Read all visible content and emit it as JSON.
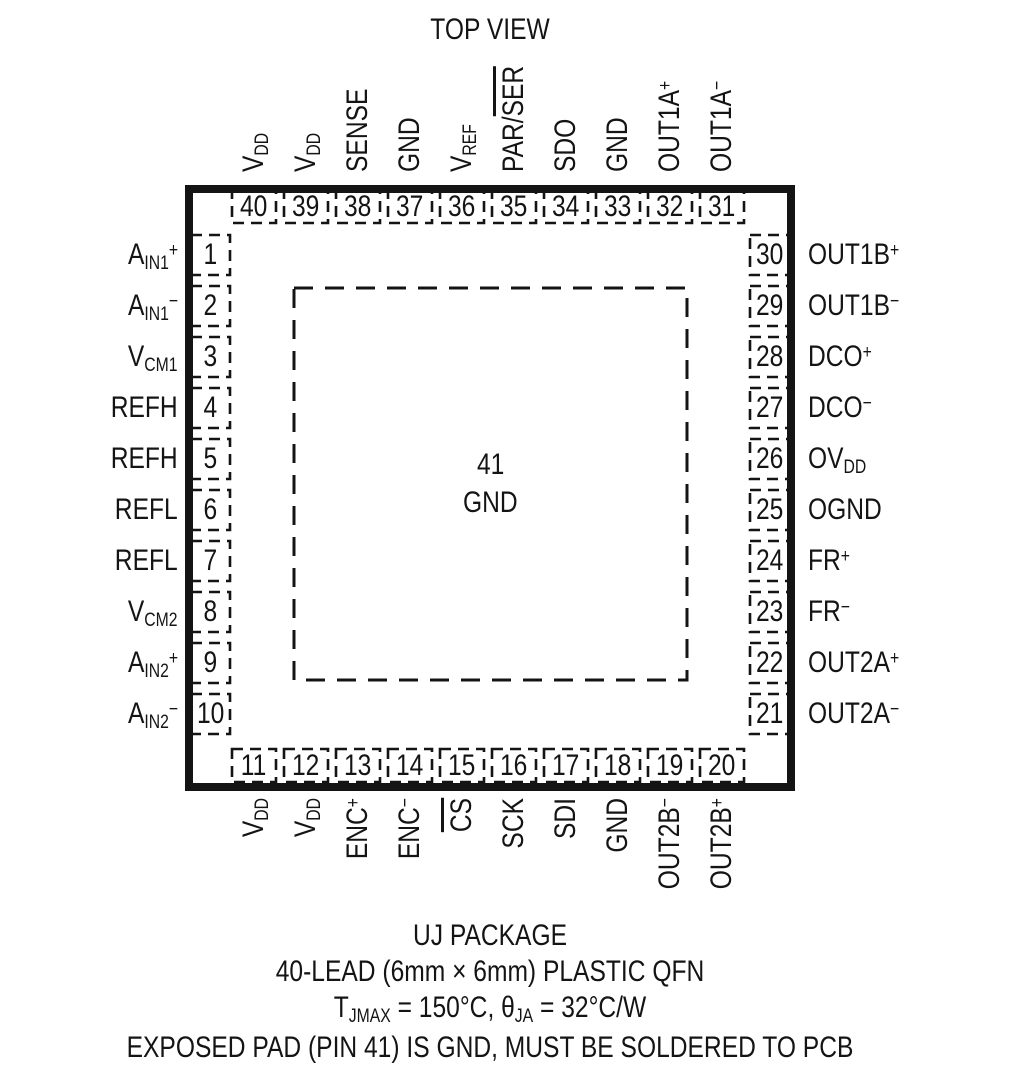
{
  "title": "TOP VIEW",
  "colors": {
    "ink": "#141414",
    "background": "#ffffff"
  },
  "package": {
    "center_pad": {
      "number": "41",
      "label": "GND"
    }
  },
  "pins": {
    "top": [
      {
        "num": "40",
        "label": [
          [
            "V"
          ],
          [
            "DD",
            "sub"
          ]
        ]
      },
      {
        "num": "39",
        "label": [
          [
            "V"
          ],
          [
            "DD",
            "sub"
          ]
        ]
      },
      {
        "num": "38",
        "label": [
          [
            "SENSE"
          ]
        ]
      },
      {
        "num": "37",
        "label": [
          [
            "GND"
          ]
        ]
      },
      {
        "num": "36",
        "label": [
          [
            "V"
          ],
          [
            "REF",
            "sub"
          ]
        ]
      },
      {
        "num": "35",
        "label": [
          [
            "PAR/"
          ],
          [
            "SER",
            "over"
          ]
        ]
      },
      {
        "num": "34",
        "label": [
          [
            "SDO"
          ]
        ]
      },
      {
        "num": "33",
        "label": [
          [
            "GND"
          ]
        ]
      },
      {
        "num": "32",
        "label": [
          [
            "OUT1A"
          ],
          [
            "+",
            "sup"
          ]
        ]
      },
      {
        "num": "31",
        "label": [
          [
            "OUT1A"
          ],
          [
            "−",
            "sup"
          ]
        ]
      }
    ],
    "left": [
      {
        "num": "1",
        "label": [
          [
            "A"
          ],
          [
            "IN1",
            "sub"
          ],
          [
            "+",
            "sup"
          ]
        ]
      },
      {
        "num": "2",
        "label": [
          [
            "A"
          ],
          [
            "IN1",
            "sub"
          ],
          [
            "−",
            "sup"
          ]
        ]
      },
      {
        "num": "3",
        "label": [
          [
            "V"
          ],
          [
            "CM1",
            "sub"
          ]
        ]
      },
      {
        "num": "4",
        "label": [
          [
            "REFH"
          ]
        ]
      },
      {
        "num": "5",
        "label": [
          [
            "REFH"
          ]
        ]
      },
      {
        "num": "6",
        "label": [
          [
            "REFL"
          ]
        ]
      },
      {
        "num": "7",
        "label": [
          [
            "REFL"
          ]
        ]
      },
      {
        "num": "8",
        "label": [
          [
            "V"
          ],
          [
            "CM2",
            "sub"
          ]
        ]
      },
      {
        "num": "9",
        "label": [
          [
            "A"
          ],
          [
            "IN2",
            "sub"
          ],
          [
            "+",
            "sup"
          ]
        ]
      },
      {
        "num": "10",
        "label": [
          [
            "A"
          ],
          [
            "IN2",
            "sub"
          ],
          [
            "−",
            "sup"
          ]
        ]
      }
    ],
    "right": [
      {
        "num": "30",
        "label": [
          [
            "OUT1B"
          ],
          [
            "+",
            "sup"
          ]
        ]
      },
      {
        "num": "29",
        "label": [
          [
            "OUT1B"
          ],
          [
            "−",
            "sup"
          ]
        ]
      },
      {
        "num": "28",
        "label": [
          [
            "DCO"
          ],
          [
            "+",
            "sup"
          ]
        ]
      },
      {
        "num": "27",
        "label": [
          [
            "DCO"
          ],
          [
            "−",
            "sup"
          ]
        ]
      },
      {
        "num": "26",
        "label": [
          [
            "OV"
          ],
          [
            "DD",
            "sub"
          ]
        ]
      },
      {
        "num": "25",
        "label": [
          [
            "OGND"
          ]
        ]
      },
      {
        "num": "24",
        "label": [
          [
            "FR"
          ],
          [
            "+",
            "sup"
          ]
        ]
      },
      {
        "num": "23",
        "label": [
          [
            "FR"
          ],
          [
            "−",
            "sup"
          ]
        ]
      },
      {
        "num": "22",
        "label": [
          [
            "OUT2A"
          ],
          [
            "+",
            "sup"
          ]
        ]
      },
      {
        "num": "21",
        "label": [
          [
            "OUT2A"
          ],
          [
            "−",
            "sup"
          ]
        ]
      }
    ],
    "bottom": [
      {
        "num": "11",
        "label": [
          [
            "V"
          ],
          [
            "DD",
            "sub"
          ]
        ]
      },
      {
        "num": "12",
        "label": [
          [
            "V"
          ],
          [
            "DD",
            "sub"
          ]
        ]
      },
      {
        "num": "13",
        "label": [
          [
            "ENC"
          ],
          [
            "+",
            "sup"
          ]
        ]
      },
      {
        "num": "14",
        "label": [
          [
            "ENC"
          ],
          [
            "−",
            "sup"
          ]
        ]
      },
      {
        "num": "15",
        "label": [
          [
            "CS",
            "over"
          ]
        ]
      },
      {
        "num": "16",
        "label": [
          [
            "SCK"
          ]
        ]
      },
      {
        "num": "17",
        "label": [
          [
            "SDI"
          ]
        ]
      },
      {
        "num": "18",
        "label": [
          [
            "GND"
          ]
        ]
      },
      {
        "num": "19",
        "label": [
          [
            "OUT2B"
          ],
          [
            "−",
            "sup"
          ]
        ]
      },
      {
        "num": "20",
        "label": [
          [
            "OUT2B"
          ],
          [
            "+",
            "sup"
          ]
        ]
      }
    ]
  },
  "footer": {
    "lines": [
      [
        [
          "UJ PACKAGE"
        ]
      ],
      [
        [
          "40-LEAD (6mm × 6mm) PLASTIC QFN"
        ]
      ],
      [
        [
          "T"
        ],
        [
          "JMAX",
          "sub"
        ],
        [
          " = 150°C, θ"
        ],
        [
          "JA",
          "sub"
        ],
        [
          " = 32°C/W"
        ]
      ],
      [
        [
          "EXPOSED PAD (PIN 41) IS GND, MUST BE SOLDERED TO PCB"
        ]
      ]
    ]
  }
}
